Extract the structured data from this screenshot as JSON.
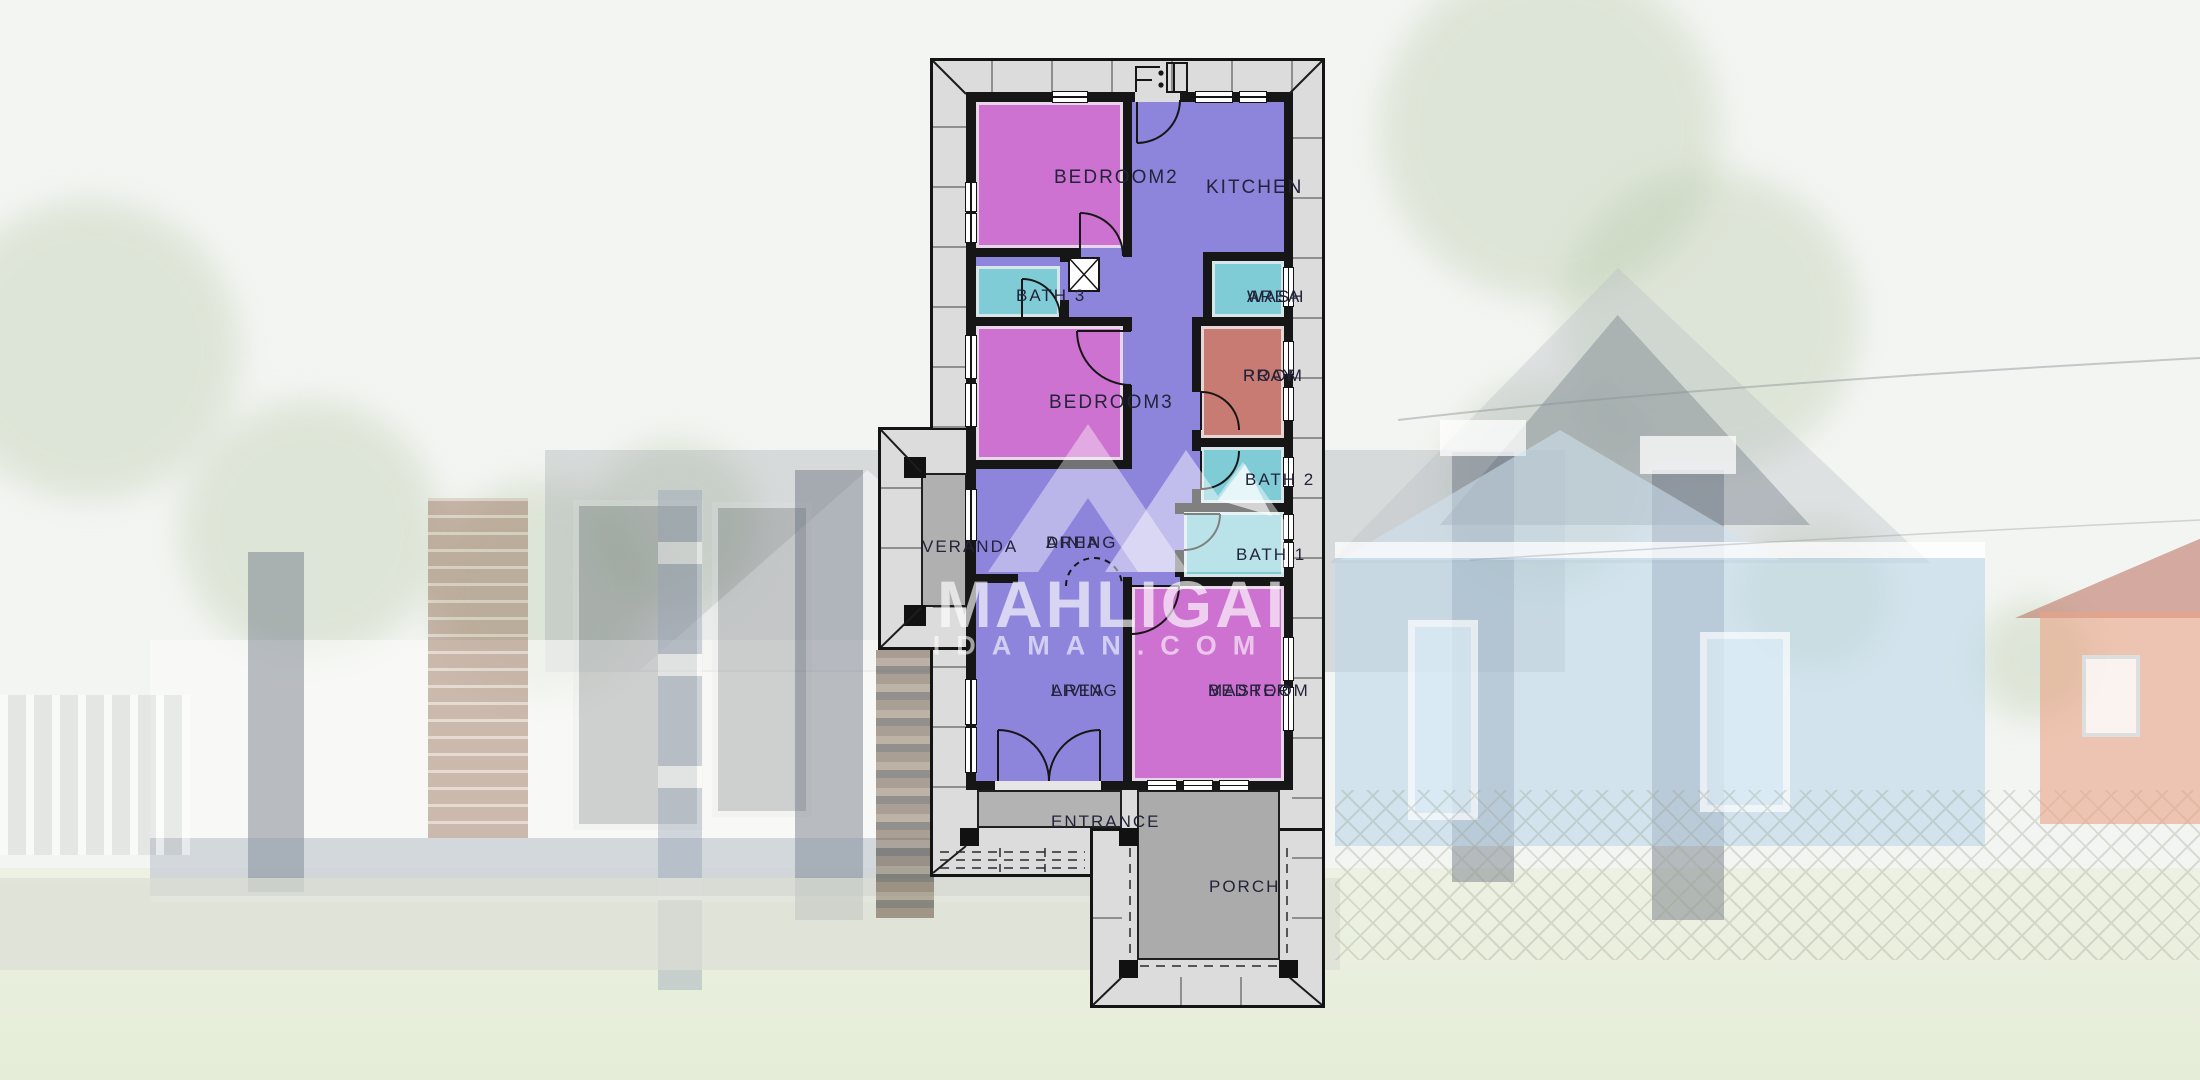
{
  "watermark": {
    "logo": "mountain-m-logo",
    "brand_line1": "MAHLIGAI",
    "brand_line2": "IDAMAN.COM"
  },
  "palette": {
    "wall": "#161616",
    "eave_band": "#dcdcdc",
    "corridor_purple": "#8d85dc",
    "bedroom_pink": "#cd72d0",
    "bath_teal": "#7fccd6",
    "pray_salmon": "#c77b72",
    "veranda_gray": "#b0b0b0",
    "entrance_gray": "#b3b3b3",
    "porch_gray": "#ababab",
    "label_color": "#23233a"
  },
  "rooms": [
    {
      "id": "bedroom2",
      "lines": [
        "BEDROOM2"
      ]
    },
    {
      "id": "kitchen",
      "lines": [
        "KITCHEN"
      ]
    },
    {
      "id": "bath3",
      "lines": [
        "BATH 3"
      ]
    },
    {
      "id": "wash-area",
      "lines": [
        "WASH",
        "AREA"
      ]
    },
    {
      "id": "bedroom3",
      "lines": [
        "BEDROOM3"
      ]
    },
    {
      "id": "pray-room",
      "lines": [
        "PRAY",
        "ROOM"
      ]
    },
    {
      "id": "bath2",
      "lines": [
        "BATH 2"
      ]
    },
    {
      "id": "bath1",
      "lines": [
        "BATH 1"
      ]
    },
    {
      "id": "veranda",
      "lines": [
        "VERANDA"
      ]
    },
    {
      "id": "dining-area",
      "lines": [
        "DINING",
        "AREA"
      ]
    },
    {
      "id": "living-area",
      "lines": [
        "LIVING",
        "AREA"
      ]
    },
    {
      "id": "master-bedroom",
      "lines": [
        "MASTER",
        "BEDROOM"
      ]
    },
    {
      "id": "entrance",
      "lines": [
        "ENTRANCE"
      ]
    },
    {
      "id": "porch",
      "lines": [
        "PORCH"
      ]
    }
  ]
}
